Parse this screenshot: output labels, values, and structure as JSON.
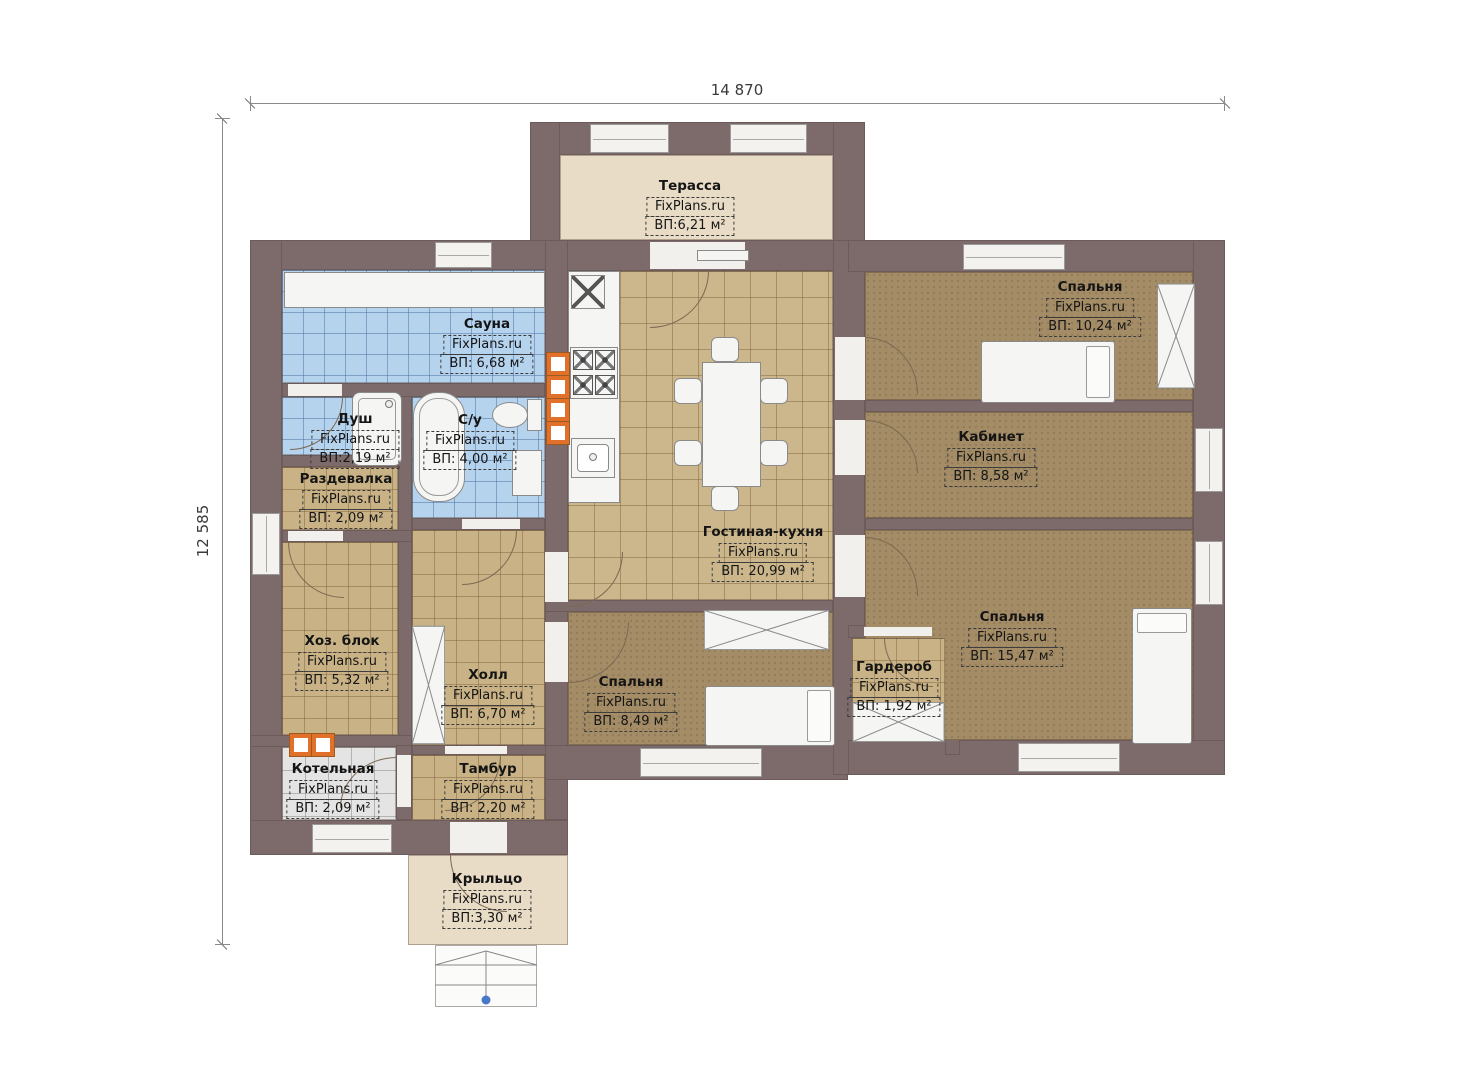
{
  "dimensions": {
    "top": "14 870",
    "left": "12 585"
  },
  "watermark": "FixPlans.ru",
  "rooms": [
    {
      "name": "Терасса",
      "area": "ВП:6,21 м²"
    },
    {
      "name": "Сауна",
      "area": "ВП: 6,68 м²"
    },
    {
      "name": "Душ",
      "area": "ВП:2,19 м²"
    },
    {
      "name": "С/у",
      "area": "ВП: 4,00 м²"
    },
    {
      "name": "Раздевалка",
      "area": "ВП: 2,09 м²"
    },
    {
      "name": "Хоз. блок",
      "area": "ВП: 5,32 м²"
    },
    {
      "name": "Холл",
      "area": "ВП: 6,70 м²"
    },
    {
      "name": "Котельная",
      "area": "ВП: 2,09 м²"
    },
    {
      "name": "Тамбур",
      "area": "ВП: 2,20 м²"
    },
    {
      "name": "Гостиная-кухня",
      "area": "ВП: 20,99 м²"
    },
    {
      "name": "Спальня",
      "area": "ВП: 10,24 м²"
    },
    {
      "name": "Кабинет",
      "area": "ВП: 8,58 м²"
    },
    {
      "name": "Спальня",
      "area": "ВП: 15,47 м²"
    },
    {
      "name": "Гардероб",
      "area": "ВП: 1,92 м²"
    },
    {
      "name": "Спальня",
      "area": "ВП: 8,49 м²"
    },
    {
      "name": "Крыльцо",
      "area": "ВП:3,30 м²"
    }
  ],
  "colors": {
    "wall": "#7d6a6a",
    "wood_floor": "#ccb78c",
    "bedroom_floor": "#a48d66",
    "tile_blue": "#b6d3ee",
    "tile_gray": "#e4e4e4",
    "terrace_floor": "#e8dcc6",
    "marker_orange": "#e0702a",
    "step_dot_blue": "#4a78c8"
  }
}
